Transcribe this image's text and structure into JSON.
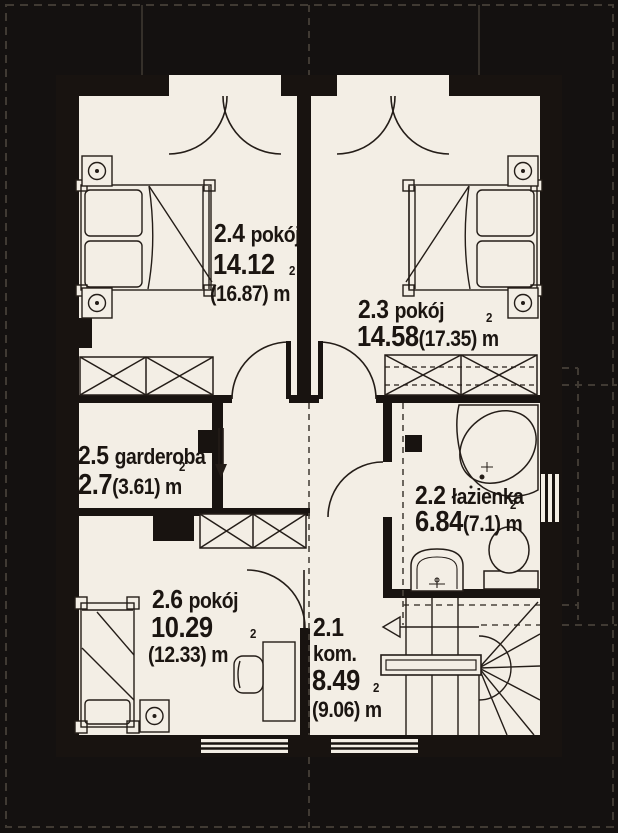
{
  "plan": {
    "type": "floor-plan",
    "rooms": [
      {
        "number": "2.4",
        "name": "pokój",
        "area": "14.12",
        "area_alt": "(16.87) m",
        "sup": "2"
      },
      {
        "number": "2.3",
        "name": "pokój",
        "area": "14.58",
        "area_alt": "(17.35) m",
        "sup": "2"
      },
      {
        "number": "2.5",
        "name": "garderoba",
        "area": "2.7",
        "area_alt": "(3.61) m",
        "sup": "2"
      },
      {
        "number": "2.2",
        "name": "łazienka",
        "area": "6.84",
        "area_alt": "(7.1) m",
        "sup": "2"
      },
      {
        "number": "2.6",
        "name": "pokój",
        "area": "10.29",
        "area_alt": "(12.33) m",
        "sup": "2"
      },
      {
        "number": "2.1",
        "name": "kom.",
        "area": "8.49",
        "area_alt": "(9.06) m",
        "sup": "2"
      }
    ],
    "colors": {
      "background": "#141110",
      "floor": "#f3eee5",
      "wall": "#181310",
      "line": "#241d18",
      "roof_dash": "#403a33"
    }
  }
}
